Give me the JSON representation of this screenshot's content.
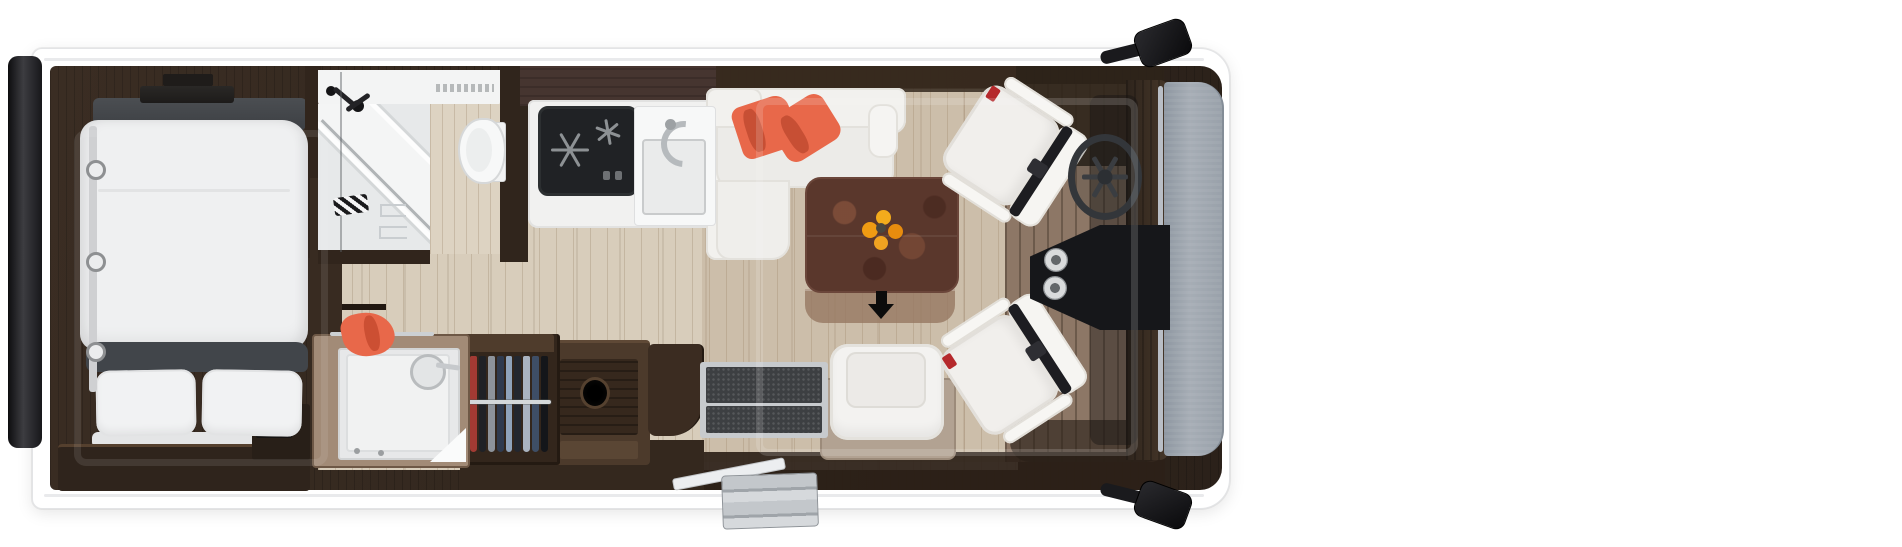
{
  "scene": {
    "description": "Top-down 3D floor plan rendering of a motorhome interior, no visible text",
    "background": "#ffffff"
  },
  "colors": {
    "body": "#ffffff",
    "outline": "#e3e4e6",
    "wood_dark": "#33281e",
    "wood_mid": "#4c3a2b",
    "floor_light": "#d8cdbb",
    "floor_cab": "#8d7766",
    "hood_gray": "#99a1aa",
    "chrome": "#c9cdd0",
    "white_furniture": "#f2f1ee",
    "duvet": "#eff0f1",
    "dark_gray_band": "#41454a",
    "accent_orange": "#e8684a",
    "table_top": "#5a372c",
    "flower": "#f09d18",
    "glass": "#e7e9ea",
    "mat_dark": "#3d3f42"
  },
  "vehicle": {
    "view": "top-down",
    "sections": {
      "rear": [
        "rear-bumper-bar"
      ],
      "bedroom": [
        "tv-bracket",
        "tv",
        "headboard",
        "double-bed-duvet",
        "mid-band",
        "pillow-left",
        "pillow-right",
        "bed-side-rail",
        "reading-light x3",
        "foot-cabinet",
        "bedside-cabinet",
        "roof-window-outline"
      ],
      "bathroom": [
        "vanity-counter",
        "vent-slots",
        "corner-shower-tray",
        "shower-glass",
        "shower-mixer-heads",
        "striped-towel",
        "toilet-room-wood-floor",
        "toilet",
        "sliding-door-handles x2"
      ],
      "kitchen": [
        "overhead-lockers",
        "worktop",
        "gas-hob-2-burner",
        "hob-knobs",
        "sink-basin",
        "faucet"
      ],
      "midship": [
        "shelf-partition",
        "shower-cubicle",
        "hand-shower",
        "orange-towel",
        "chrome-towel-rail",
        "glass-door-triangle",
        "hanging-wardrobe-with-clothes",
        "chrome-clothes-rail",
        "sideboard-with-bottle-holder",
        "curved-cabinet",
        "interior-entry-step-mats x2"
      ],
      "lounge": [
        "overhead-locker-band",
        "l-shaped-sofa",
        "orange-cushions x2",
        "sofa-end-armrest",
        "dining-table",
        "flower-bouquet",
        "table-extension-leaf",
        "entrance-arrow",
        "side-seat",
        "side-seat-pedestal",
        "roof-window-outline"
      ],
      "cab": [
        "swivel-captain-seat-upper",
        "swivel-captain-seat-lower",
        "seatbelts",
        "steering-wheel",
        "dashboard-smoke-band",
        "center-console",
        "cupholders x2",
        "a-pillar-band",
        "windshield-hood-gray"
      ],
      "exterior": [
        "wing-mirror-top",
        "wing-mirror-bottom",
        "open-entry-door",
        "folding-entry-steps"
      ]
    }
  },
  "indicators": {
    "entrance_arrow": {
      "direction": "down",
      "color": "#0c0c0c"
    }
  },
  "counts": {
    "swivel_seats": 2,
    "pillows": 2,
    "cupholders": 2,
    "mirrors": 2,
    "reading_lights": 3,
    "orange_cushions": 2,
    "hob_burners": 2
  },
  "clothes_strip_colors": [
    "#a23a33",
    "#1f2126",
    "#8d939b",
    "#2f3a4e",
    "#8fa3bb",
    "#23272f",
    "#aab3c0",
    "#3e4e66",
    "#14161a"
  ]
}
